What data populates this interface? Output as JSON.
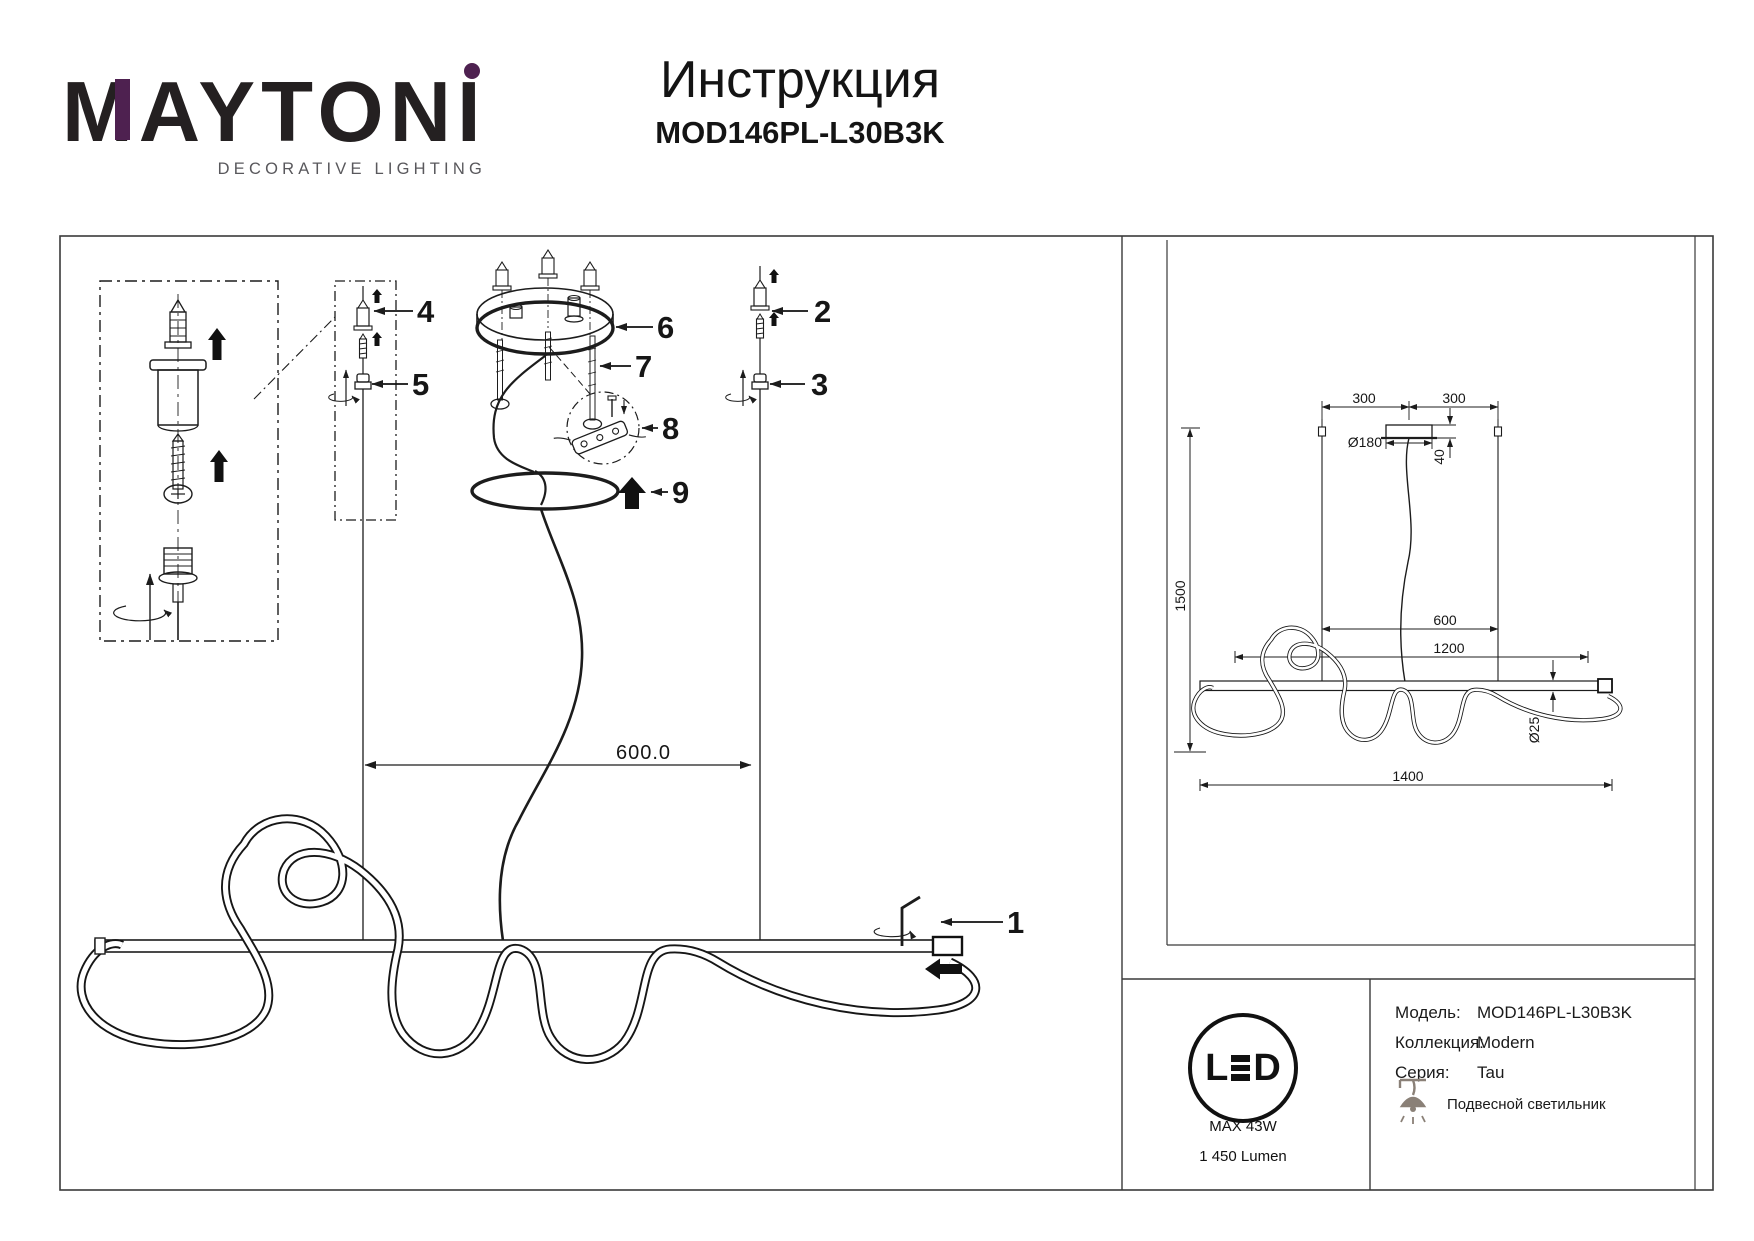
{
  "logo": {
    "brand_main": "MAYTON",
    "brand_i": "I",
    "tagline": "DECORATIVE LIGHTING",
    "accent_purple": "#4e2150",
    "ink": "#242021"
  },
  "header": {
    "title": "Инструкция",
    "model": "MOD146PL-L30B3K"
  },
  "assembly": {
    "parts": [
      "1",
      "2",
      "3",
      "4",
      "5",
      "6",
      "7",
      "8",
      "9"
    ],
    "suspension_dim": "600.0"
  },
  "drawing": {
    "dims": {
      "left_300": "300",
      "right_300": "300",
      "canopy_diameter": "Ø180",
      "canopy_height": "40",
      "overall_height": "1500",
      "suspension_span": "600",
      "inner_length": "1200",
      "tube_diameter": "Ø25",
      "total_length": "1400"
    }
  },
  "specs": {
    "led_l": "L",
    "led_d": "D",
    "max_power": "MAX 43W",
    "luminous_flux": "1 450 Lumen",
    "rows": [
      {
        "label": "Модель:",
        "value": "MOD146PL-L30B3K"
      },
      {
        "label": "Коллекция:",
        "value": "Modern"
      },
      {
        "label": "Серия:",
        "value": "Tau"
      }
    ],
    "fixture_type": "Подвесной светильник"
  }
}
